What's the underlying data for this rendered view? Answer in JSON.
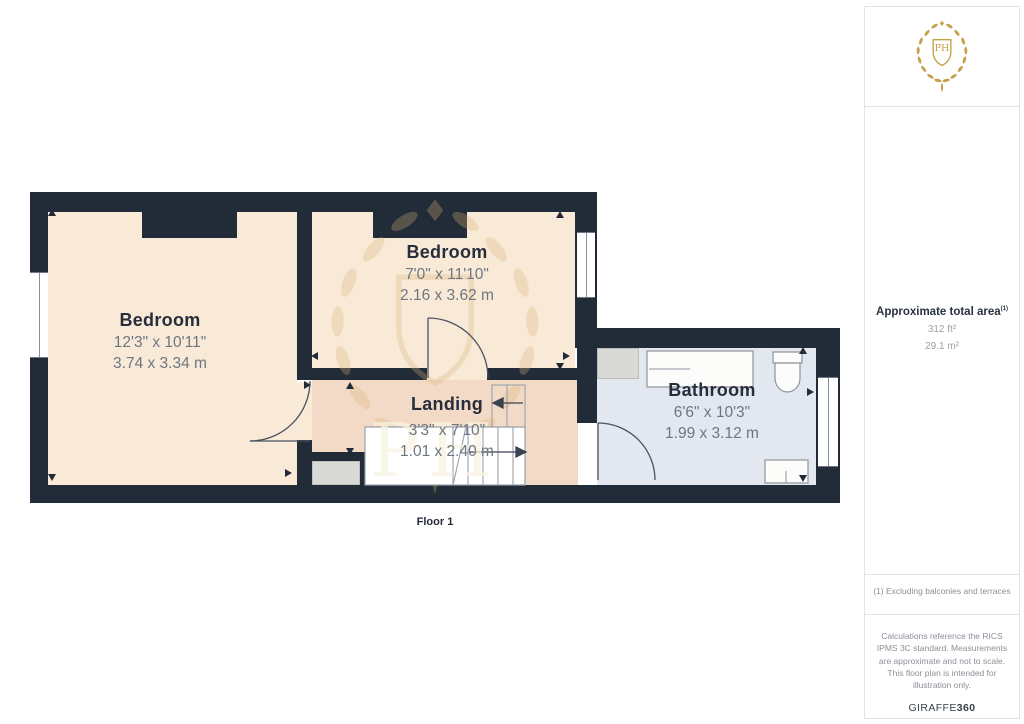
{
  "floor_plan": {
    "floor_label": "Floor 1",
    "watermark_monogram": "PH",
    "rooms": [
      {
        "name": "Bedroom",
        "dims_imperial": "12'3\" x 10'11\"",
        "dims_metric": "3.74 x 3.34 m"
      },
      {
        "name": "Bedroom",
        "dims_imperial": "7'0\" x 11'10\"",
        "dims_metric": "2.16 x 3.62 m"
      },
      {
        "name": "Landing",
        "dims_imperial": "3'3\" x 7'10\"",
        "dims_metric": "1.01 x 2.40 m"
      },
      {
        "name": "Bathroom",
        "dims_imperial": "6'6\" x 10'3\"",
        "dims_metric": "1.99 x 3.12 m"
      }
    ]
  },
  "sidebar": {
    "logo_monogram": "PH",
    "area": {
      "title": "Approximate total area",
      "title_superscript": "(1)",
      "value_imperial": "312 ft²",
      "value_metric": "29.1 m²"
    },
    "note": "(1) Excluding balconies and terraces",
    "disclaimer": "Calculations reference the RICS IPMS 3C standard. Measurements are approximate and not to scale. This floor plan is intended for illustration only.",
    "brand": {
      "name": "GIRAFFE",
      "suffix": "360"
    }
  },
  "colors": {
    "wall": "#222B38",
    "bedroom_floor": "#F9EAD8",
    "landing_floor": "#F2DAC6",
    "bathroom_floor": "#E3E7F0",
    "fixture_gray": "#D9D9D5",
    "logo_gold": "#C5A04A",
    "dim_text": "#6E7681",
    "room_text": "#262D3B"
  }
}
